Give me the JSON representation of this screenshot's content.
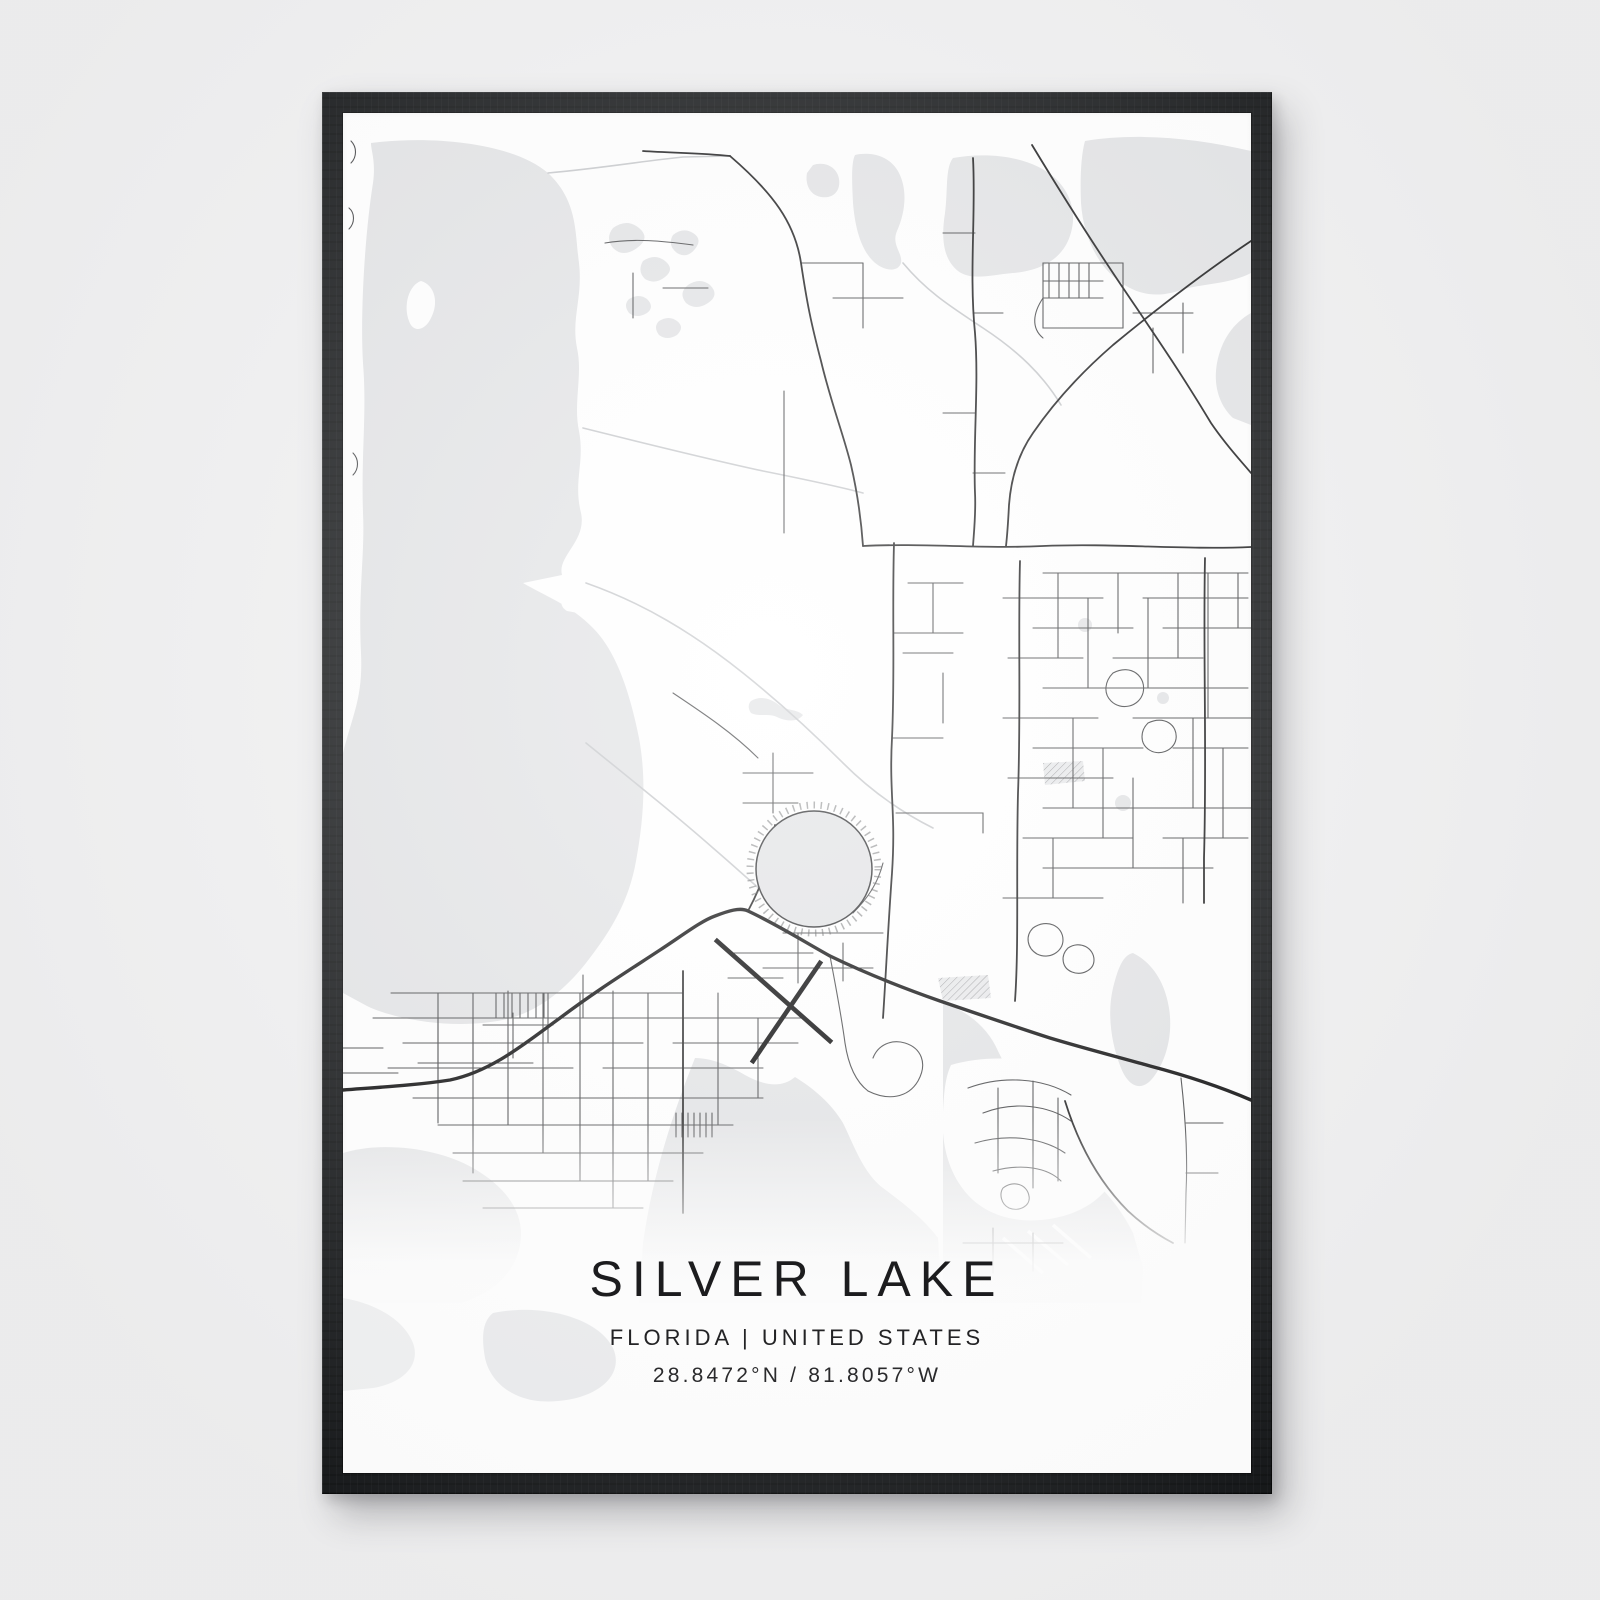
{
  "poster": {
    "title": "SILVER LAKE",
    "subtitle": "FLORIDA | UNITED STATES",
    "coordinates": "28.8472°N / 81.8057°W",
    "location": {
      "city": "Silver Lake",
      "region": "FLORIDA",
      "country": "UNITED STATES",
      "latitude": "28.8472°N",
      "longitude": "81.8057°W"
    }
  },
  "style": {
    "wall_color": "#f0f0f1",
    "frame_color": "#17191b",
    "paper_color": "#ffffff",
    "water_color": "#e3e4e6",
    "road_major_color": "#111111",
    "road_street_color": "#4a4b4d",
    "road_minor_color": "#c7c9cc"
  }
}
